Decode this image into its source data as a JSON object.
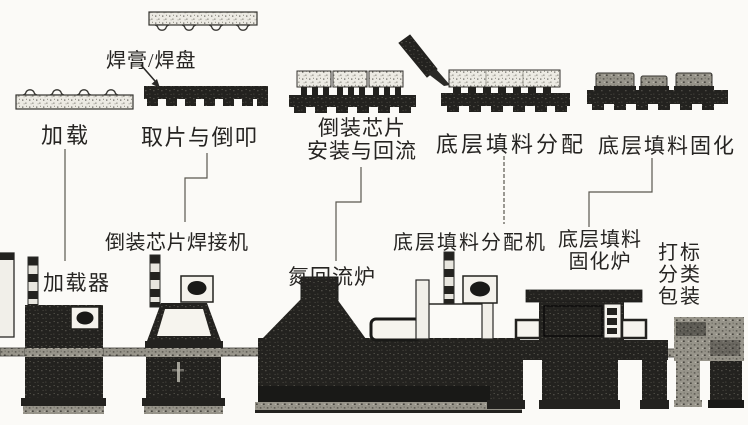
{
  "figure": {
    "background": "#fbfaf7",
    "ink": "#262422",
    "art_colors": {
      "machine_dark": "#23221f",
      "board_light": "#eceae3",
      "texture_mid": "#97948a",
      "panel_white": "#f4f2ec"
    }
  },
  "callout": {
    "label": "焊膏/焊盘"
  },
  "process_steps": [
    {
      "label": "加载"
    },
    {
      "label": "取片与倒叩"
    },
    {
      "label_line1": "倒装芯片",
      "label_line2": "安装与回流"
    },
    {
      "label": "底层填料分配"
    },
    {
      "label": "底层填料固化"
    }
  ],
  "machines": [
    {
      "label": "加载器"
    },
    {
      "label": "倒装芯片焊接机"
    },
    {
      "label": "氮回流炉"
    },
    {
      "label": "底层填料分配机"
    },
    {
      "label_line1": "底层填料",
      "label_line2": "固化炉"
    },
    {
      "label_line1": "打标",
      "label_line2": "分类",
      "label_line3": "包装"
    }
  ]
}
